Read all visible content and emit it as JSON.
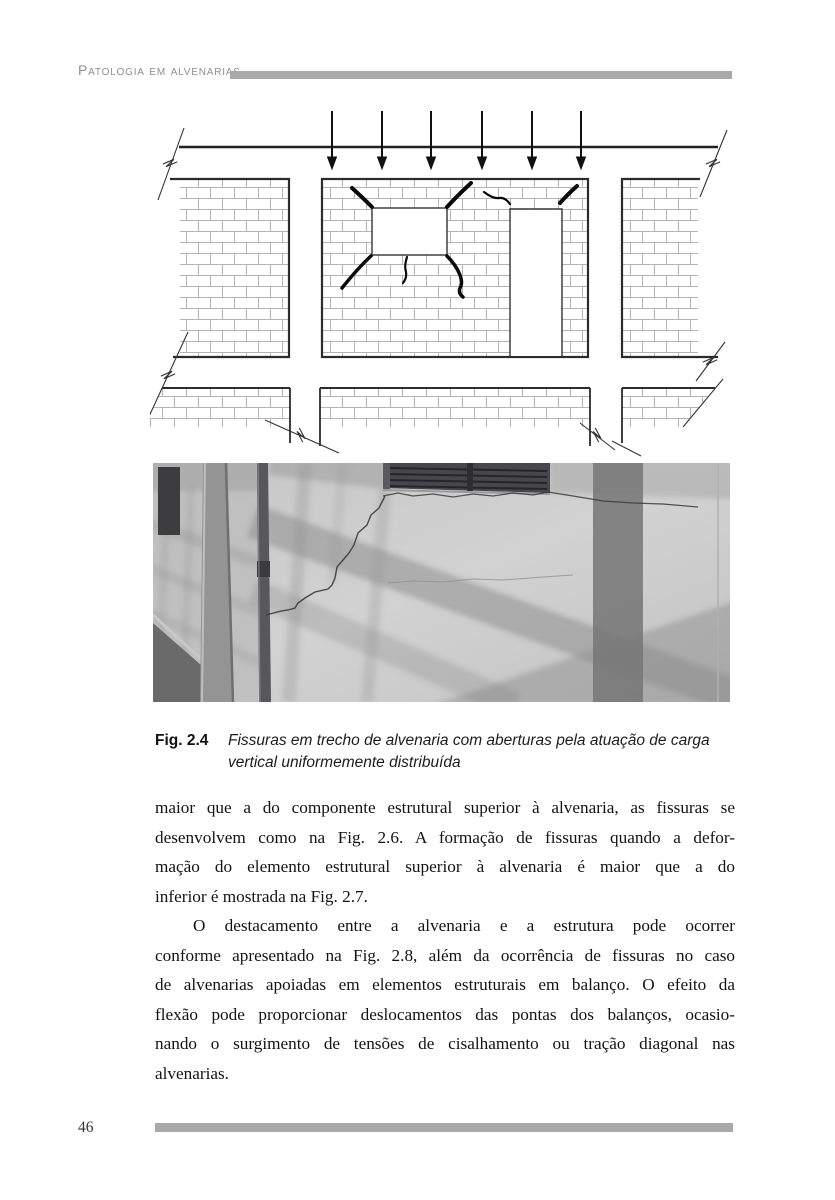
{
  "header": {
    "running_title": "Patologia em alvenarias"
  },
  "figure": {
    "label": "Fig. 2.4",
    "caption": "Fissuras em trecho de alvenaria com aberturas pela atuação de carga vertical uniformemente distribuída",
    "diagram_meaning": "masonry-walls-with-openings-under-uniform-vertical-load",
    "photo_meaning": "cracked-plastered-wall-below-window"
  },
  "body": {
    "p1_lines": [
      "maior que a do componente estrutural superior à alvenaria, as fissuras se",
      "desenvolvem como na Fig. 2.6. A formação de fissuras quando a defor-",
      "mação do elemento estrutural superior à alvenaria é maior que a do",
      "inferior é mostrada na Fig. 2.7."
    ],
    "p2_lines": [
      "O destacamento entre a alvenaria e a estrutura pode ocorrer",
      "conforme apresentado na Fig. 2.8, além da ocorrência de fissuras no caso",
      "de alvenarias apoiadas em elementos estruturais em balanço. O efeito da",
      "flexão pode proporcionar deslocamentos das pontas dos balanços, ocasio-",
      "nando o surgimento de tensões de cisalhamento ou tração diagonal nas",
      "alvenarias."
    ]
  },
  "footer": {
    "page_number": "46"
  },
  "colors": {
    "rule_gray": "#a9a9a9",
    "running_title_gray": "#8f8f8f",
    "ink": "#141414",
    "diagram_line": "#2b2b2b",
    "brick_joint": "#b4b4b4"
  }
}
